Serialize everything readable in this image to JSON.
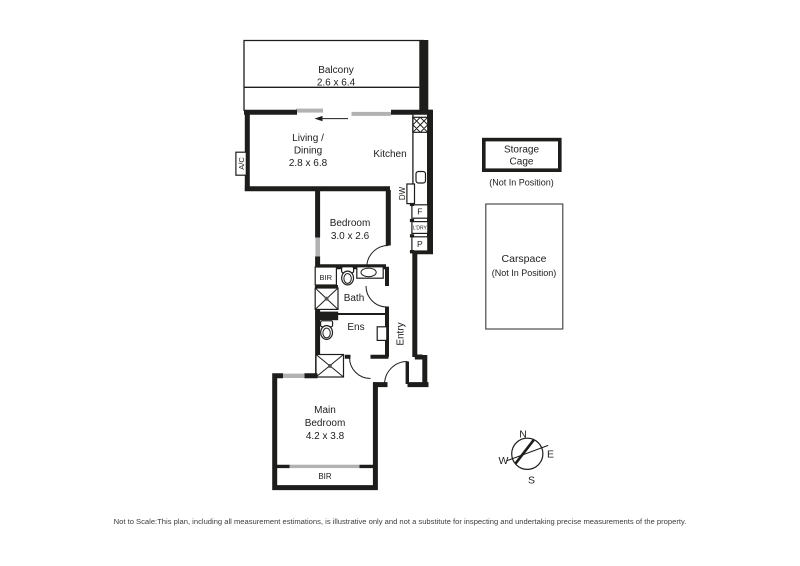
{
  "plan": {
    "rooms": {
      "balcony": {
        "name": "Balcony",
        "dims": "2.6 x 6.4"
      },
      "living": {
        "name_line1": "Living /",
        "name_line2": "Dining",
        "dims": "2.8 x 6.8"
      },
      "kitchen": {
        "name": "Kitchen"
      },
      "bedroom": {
        "name": "Bedroom",
        "dims": "3.0 x 2.6"
      },
      "bath": {
        "name": "Bath"
      },
      "ens": {
        "name": "Ens"
      },
      "entry": {
        "name": "Entry"
      },
      "main_bedroom": {
        "name_line1": "Main",
        "name_line2": "Bedroom",
        "dims": "4.2 x 3.8"
      }
    },
    "fixtures": {
      "ac": "A/C",
      "dw": "DW",
      "fridge": "F",
      "laundry": "L'DRY",
      "pantry": "P",
      "bir_bath": "BIR",
      "bir_main": "BIR"
    },
    "storage": {
      "line1": "Storage",
      "line2": "Cage",
      "note": "(Not In Position)"
    },
    "carspace": {
      "name": "Carspace",
      "note": "(Not In Position)"
    },
    "compass": {
      "n": "N",
      "e": "E",
      "s": "S",
      "w": "W"
    },
    "disclaimer": "Not to Scale:This plan, including all measurement estimations, is illustrative only and not a substitute for inspecting and undertaking precise measurements of the property.",
    "colors": {
      "wall": "#1d1d1b",
      "glass": "#b2b2b2",
      "disclaimer_text": "#3c3c3b"
    }
  }
}
